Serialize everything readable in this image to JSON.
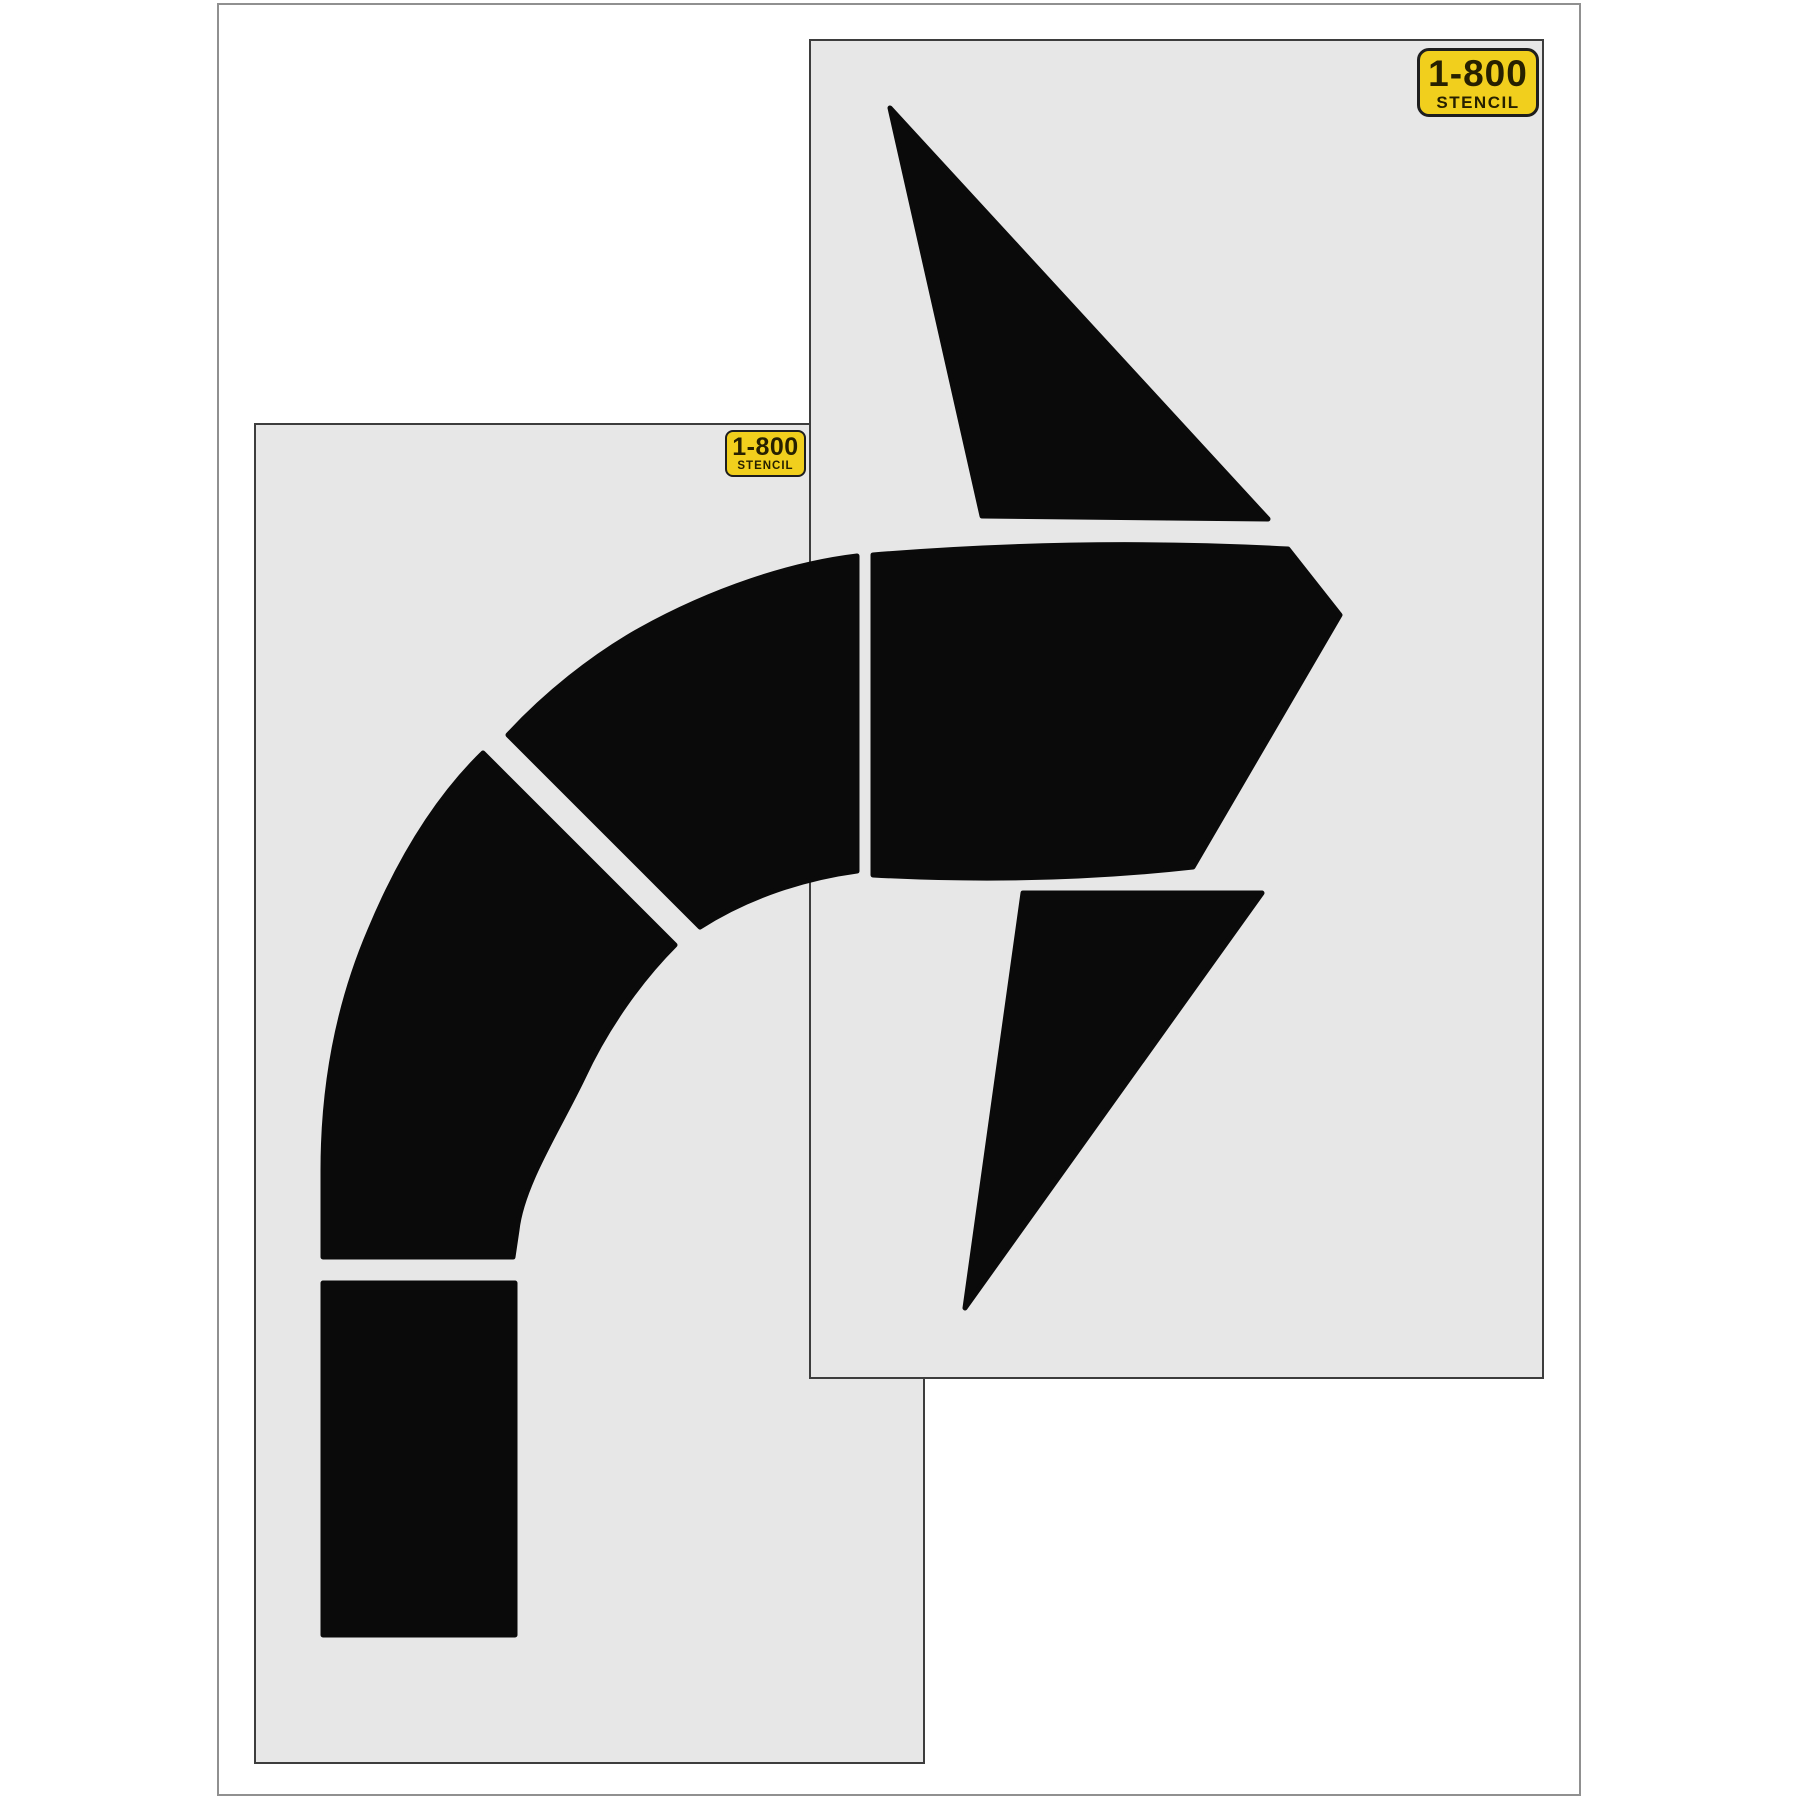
{
  "badge": {
    "line1": "1-800",
    "line2": "STENCIL"
  },
  "colors": {
    "background": "#ffffff",
    "frame-border": "#909090",
    "sheet-fill": "#e7e7e7",
    "sheet-edge": "#3d3d3d",
    "stencil-black": "#0a0a0a",
    "badge-yellow": "#f1cf1d",
    "badge-border": "#1e1e1e",
    "badge-text": "#262000"
  },
  "sheets": [
    {
      "name": "left-stencil-sheet",
      "x": 255,
      "y": 424,
      "w": 669,
      "h": 1339
    },
    {
      "name": "right-stencil-sheet",
      "x": 810,
      "y": 40,
      "w": 733,
      "h": 1338
    }
  ],
  "shapes": [
    {
      "name": "shaft-bottom-bar-cutout",
      "path": "M323,1283 L515,1283 L515,1635 L323,1635 Z"
    },
    {
      "name": "shaft-elbow-cutout",
      "path": "M483,753 L675,945 C640,980 606,1028 583,1078 C558,1130 522,1185 517,1230 L513,1257 L323,1257 L323,1170 C323,1080 340,1000 370,930 C400,858 438,797 483,753 Z"
    },
    {
      "name": "shaft-diagonal-cutout",
      "path": "M508,735 C545,695 592,657 640,630 C712,590 790,564 857,556 L857,871 C805,878 748,896 700,927 Z"
    },
    {
      "name": "arrow-body-cutout",
      "path": "M873,555 Q1080,538 1288,549 L1340,615 L1193,867 Q1040,884 873,875 Z"
    },
    {
      "name": "arrow-upper-fin-cutout",
      "path": "M890,108 L1268,519 L982,516 Z"
    },
    {
      "name": "arrow-lower-fin-cutout",
      "path": "M1023,893 L1262,893 L965,1308 Z"
    }
  ]
}
